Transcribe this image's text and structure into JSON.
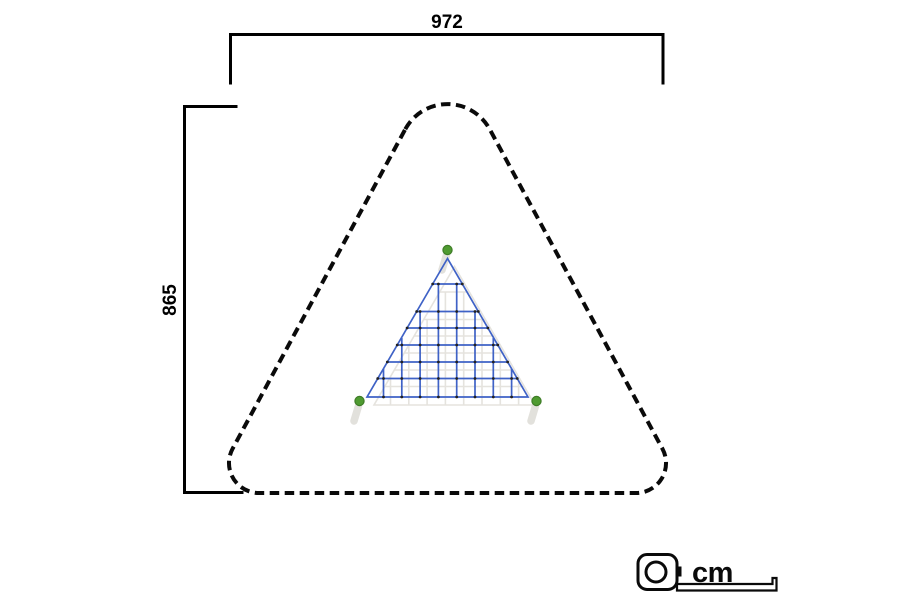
{
  "page": {
    "kind": "playground-climbing-net-plan-view",
    "background": "#ffffff"
  },
  "dimensions": {
    "width_cm": "972",
    "height_cm": "865"
  },
  "unit": {
    "label": "cm",
    "icon": "tape-measure-icon"
  },
  "colors": {
    "net_blue": "#3f62c6",
    "anchor_green": "#4f9b31",
    "anchor_green_border": "#3e7c27",
    "knot_black": "#222222",
    "shadow_gray": "#e5e3de",
    "swoosh_gray": "#dedcd6",
    "line_black": "#0a0a0a"
  },
  "figure": {
    "triangle": {
      "apex": [
        447.5,
        258.5
      ],
      "base_left": [
        367,
        397
      ],
      "base_right": [
        528,
        397
      ]
    },
    "rungs_y": [
      284,
      311.5,
      328,
      345,
      362,
      378.5
    ],
    "verticals": [
      [
        438.4,
        284
      ],
      [
        456.7,
        284
      ],
      [
        420.1,
        311.5
      ],
      [
        475.0,
        311.5
      ],
      [
        401.8,
        338
      ],
      [
        493.3,
        338
      ],
      [
        383.5,
        369
      ],
      [
        511.6,
        369
      ]
    ],
    "anchors": [
      [
        447.5,
        250
      ],
      [
        359.5,
        401
      ],
      [
        536.5,
        401
      ]
    ],
    "shadow_offset": [
      7,
      8
    ]
  }
}
